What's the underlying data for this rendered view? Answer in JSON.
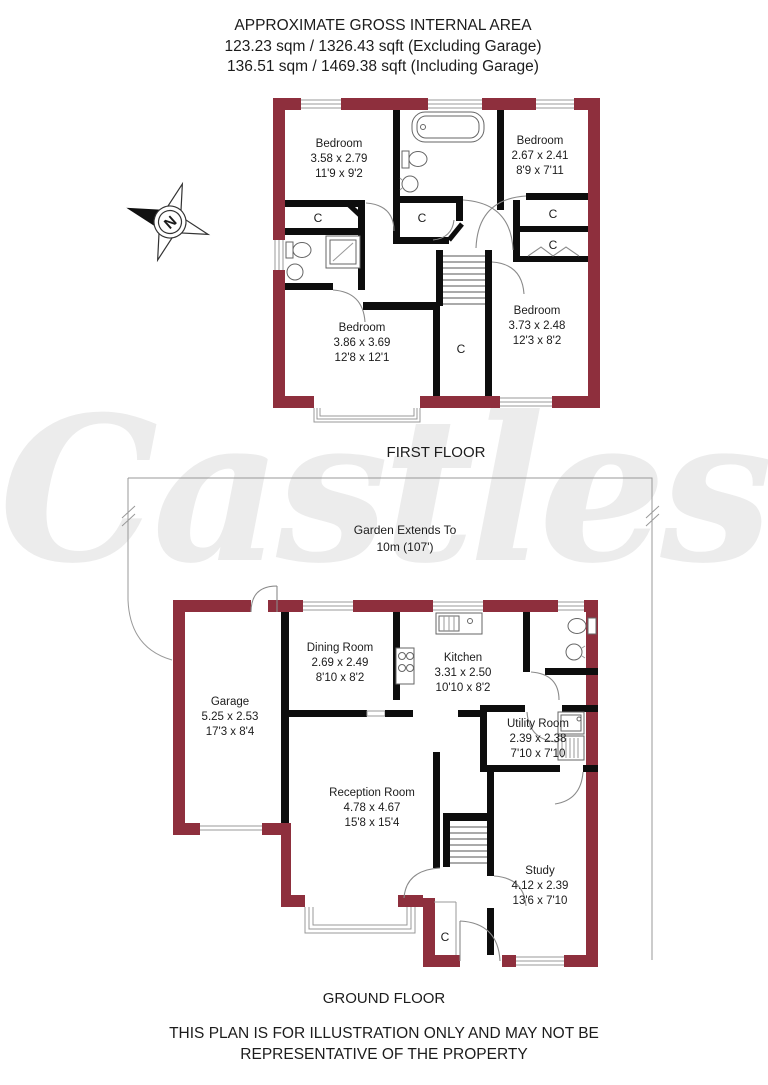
{
  "header": {
    "line1": "APPROXIMATE GROSS INTERNAL AREA",
    "line2": "123.23 sqm / 1326.43 sqft (Excluding Garage)",
    "line3": "136.51 sqm / 1469.38 sqft (Including Garage)"
  },
  "watermark": "Castles",
  "compass": {
    "letter": "N"
  },
  "first_floor": {
    "label": "FIRST FLOOR",
    "closet_label": "C",
    "rooms": [
      {
        "name": "Bedroom",
        "metric": "3.58 x 2.79",
        "imperial": "11'9 x 9'2"
      },
      {
        "name": "Bedroom",
        "metric": "2.67 x 2.41",
        "imperial": "8'9 x 7'11"
      },
      {
        "name": "Bedroom",
        "metric": "3.86 x 3.69",
        "imperial": "12'8 x 12'1"
      },
      {
        "name": "Bedroom",
        "metric": "3.73 x 2.48",
        "imperial": "12'3 x 8'2"
      }
    ]
  },
  "ground_floor": {
    "label": "GROUND FLOOR",
    "closet_label": "C",
    "garden": {
      "line1": "Garden Extends To",
      "line2": "10m (107')"
    },
    "rooms": [
      {
        "name": "Garage",
        "metric": "5.25 x 2.53",
        "imperial": "17'3 x 8'4"
      },
      {
        "name": "Dining Room",
        "metric": "2.69 x 2.49",
        "imperial": "8'10 x 8'2"
      },
      {
        "name": "Kitchen",
        "metric": "3.31 x 2.50",
        "imperial": "10'10 x 8'2"
      },
      {
        "name": "Utility Room",
        "metric": "2.39 x 2.38",
        "imperial": "7'10 x 7'10"
      },
      {
        "name": "Reception Room",
        "metric": "4.78 x 4.67",
        "imperial": "15'8 x 15'4"
      },
      {
        "name": "Study",
        "metric": "4.12 x 2.39",
        "imperial": "13'6 x 7'10"
      }
    ]
  },
  "disclaimer": {
    "line1": "THIS PLAN IS FOR ILLUSTRATION ONLY AND MAY NOT BE",
    "line2": "REPRESENTATIVE OF THE PROPERTY"
  },
  "colors": {
    "wall_exterior": "#8e2f3d",
    "wall_interior": "#0d0d0d",
    "watermark": "#ececec",
    "detail_line": "#999999"
  }
}
